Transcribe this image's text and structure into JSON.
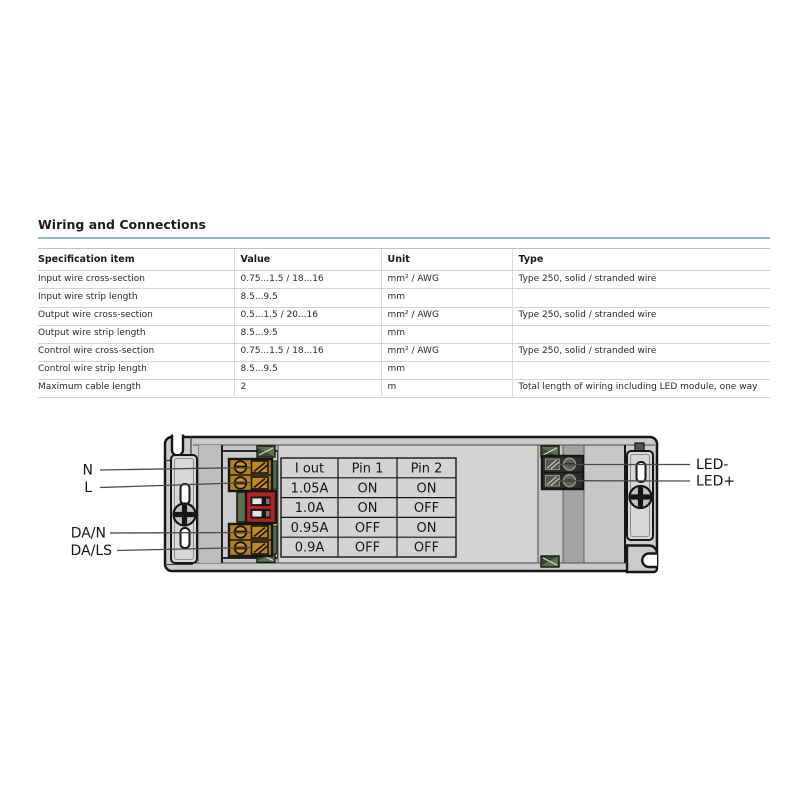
{
  "page": {
    "title": "Wiring and Connections"
  },
  "spec_table": {
    "columns": [
      "Specification item",
      "Value",
      "Unit",
      "Type"
    ],
    "rows": [
      [
        "Input wire cross-section",
        "0.75...1.5 / 18...16",
        "mm² / AWG",
        "Type 250, solid / stranded wire"
      ],
      [
        "Input wire strip length",
        "8.5...9.5",
        "mm",
        ""
      ],
      [
        "Output wire cross-section",
        "0.5...1.5 / 20...16",
        "mm² / AWG",
        "Type 250, solid / stranded wire"
      ],
      [
        "Output wire strip length",
        "8.5...9.5",
        "mm",
        ""
      ],
      [
        "Control wire cross-section",
        "0.75...1.5 / 18...16",
        "mm² / AWG",
        "Type 250, solid / stranded wire"
      ],
      [
        "Control wire strip length",
        "8.5...9.5",
        "mm",
        ""
      ],
      [
        "Maximum cable length",
        "2",
        "m",
        "Total length of wiring including LED module, one way"
      ]
    ]
  },
  "diagram": {
    "wire_labels": {
      "input_neutral": "N",
      "input_line": "L",
      "dali_n": "DA/N",
      "dali_ls": "DA/LS",
      "led_minus": "LED-",
      "led_plus": "LED+"
    },
    "dip_table": {
      "columns": [
        "I out",
        "Pin 1",
        "Pin 2"
      ],
      "rows": [
        [
          "1.05A",
          "ON",
          "ON"
        ],
        [
          "1.0A",
          "ON",
          "OFF"
        ],
        [
          "0.95A",
          "OFF",
          "ON"
        ],
        [
          "0.9A",
          "OFF",
          "OFF"
        ]
      ]
    },
    "colors": {
      "accent_rule": "#8fb6c9",
      "housing": "#cbcbc9",
      "terminal_orange": "#b5801c",
      "dip_switch_red": "#b32323",
      "clip_green": "#5c7150",
      "led_terminal_dark": "#2e2e2a"
    }
  }
}
